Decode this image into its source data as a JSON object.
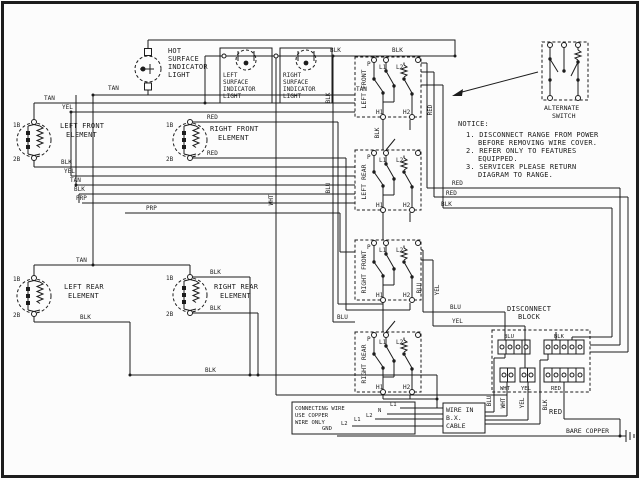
{
  "lights": {
    "hot": {
      "l1": "HOT",
      "l2": "SURFACE",
      "l3": "INDICATOR",
      "l4": "LIGHT"
    },
    "left": {
      "l1": "LEFT",
      "l2": "SURFACE",
      "l3": "INDICATOR",
      "l4": "LIGHT"
    },
    "right": {
      "l1": "RIGHT",
      "l2": "SURFACE",
      "l3": "INDICATOR",
      "l4": "LIGHT"
    }
  },
  "elements": {
    "pins": {
      "t1": "1B",
      "t2": "2B"
    },
    "left_front": {
      "n1": "LEFT FRONT",
      "n2": "ELEMENT"
    },
    "right_front": {
      "n1": "RIGHT FRONT",
      "n2": "ELEMENT"
    },
    "left_rear": {
      "n1": "LEFT REAR",
      "n2": "ELEMENT"
    },
    "right_rear": {
      "n1": "RIGHT REAR",
      "n2": "ELEMENT"
    }
  },
  "switches": {
    "pins": {
      "p": "P",
      "l1": "L1",
      "l2": "L2",
      "h1": "H1",
      "h2": "H2"
    },
    "left_front": "LEFT FRONT",
    "left_rear": "LEFT REAR",
    "right_front": "RIGHT FRONT",
    "right_rear": "RIGHT REAR",
    "alternate": {
      "l1": "ALTERNATE",
      "l2": "SWITCH"
    }
  },
  "notice": {
    "title": "NOTICE:",
    "lines": [
      "1. DISCONNECT RANGE FROM POWER",
      "BEFORE REMOVING WIRE COVER.",
      "2. REFER ONLY TO FEATURES",
      "EQUIPPED.",
      "3. SERVICER PLEASE RETURN",
      "DIAGRAM TO RANGE."
    ]
  },
  "disconnect_block": {
    "l1": "DISCONNECT",
    "l2": "BLOCK",
    "strips": {
      "blu": "BLU",
      "blk": "BLK",
      "wht": "WHT",
      "yel": "YEL",
      "red": "RED"
    }
  },
  "boxes": {
    "bx": {
      "l1": "WIRE IN",
      "l2": "B.X.",
      "l3": "CABLE"
    },
    "connecting": {
      "l1": "CONNECTING WIRE",
      "l2": "USE COPPER",
      "l3": "WIRE ONLY"
    }
  },
  "cable_labels": {
    "l1a": "L1",
    "n": "N",
    "l2a": "L2",
    "l1b": "L1",
    "l2b": "L2",
    "gnd": "GND"
  },
  "ground": {
    "red": "RED",
    "bare_copper": "BARE COPPER"
  },
  "wire_labels": {
    "tan_light": "TAN",
    "tan_bus": "TAN",
    "tan_sw": "TAN",
    "yel_bus": "YEL",
    "blk_top1": "BLK",
    "blk_top2": "BLK",
    "blk_s1": "BLK",
    "yel_s2": "YEL",
    "tan_s3": "TAN",
    "blk_s4": "BLK",
    "prp_s5": "PRP",
    "prp_s6": "PRP",
    "red_rf1": "RED",
    "red_rf2": "RED",
    "tan_lr": "TAN",
    "blk_rr1": "BLK",
    "blk_rr2": "BLK",
    "blk_lr": "BLK",
    "blk_long": "BLK",
    "red_r1": "RED",
    "red_r2": "RED",
    "blk_r3": "BLK",
    "blu_rr": "BLU",
    "blu_h": "BLU",
    "yel_h": "YEL",
    "wht_v": "WHT",
    "blk_v1": "BLK",
    "blu_v1": "BLU",
    "blk_v2": "BLK",
    "red_v1": "RED",
    "blu_v2": "BLU",
    "yel_v2": "YEL",
    "blu_v3": "BLU",
    "wht_v3": "WHT",
    "yel_v3": "YEL",
    "blk_v3": "BLK"
  },
  "colors": {
    "ink": "#1c1c1c",
    "paper": "#fcfcfc"
  }
}
